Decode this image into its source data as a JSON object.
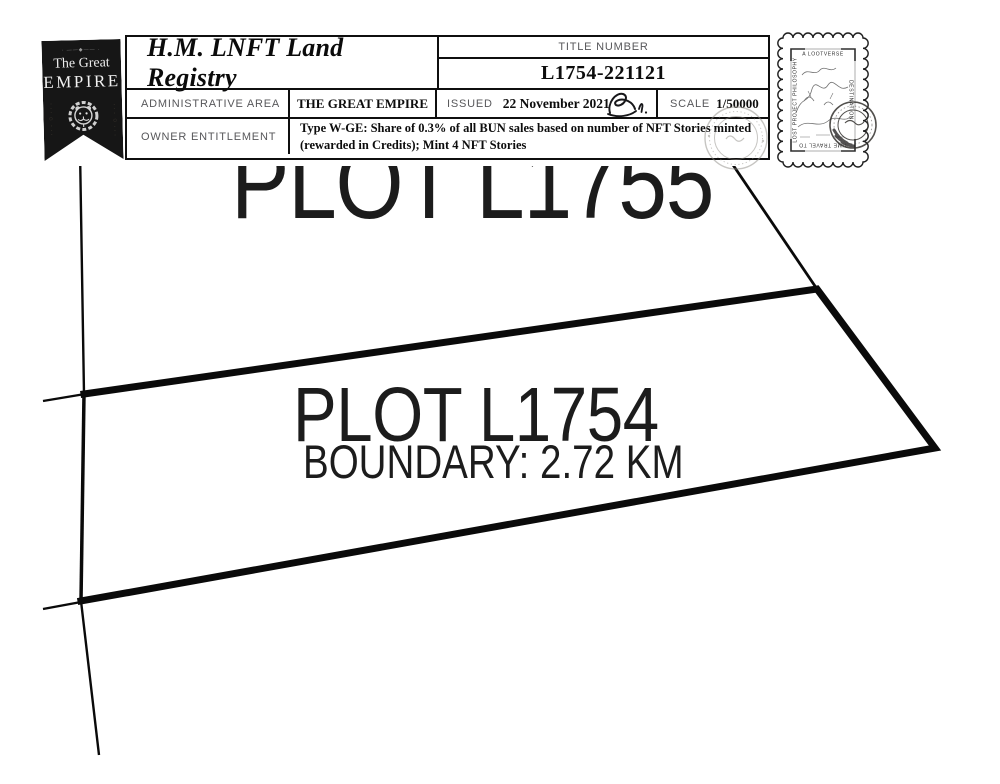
{
  "header": {
    "badge": {
      "ornament": "· ——◆—— ·",
      "line1": "The Great",
      "line2": "EMPIRE",
      "emblem_icon": "lion-crest-icon"
    },
    "registry_title": "H.M. LNFT Land Registry",
    "title_number_label": "TITLE NUMBER",
    "title_number": "L1754-221121",
    "admin_area_label": "ADMINISTRATIVE AREA",
    "admin_area_value": "THE GREAT EMPIRE",
    "issued_label": "ISSUED",
    "issued_date": "22 November 2021",
    "scale_label": "SCALE",
    "scale_value": "1/50000",
    "owner_label": "OWNER ENTITLEMENT",
    "owner_entitlement": "Type W-GE: Share of 0.3% of all BUN sales based on number of NFT Stories minted\n(rewarded in Credits); Mint 4 NFT Stories"
  },
  "stamp": {
    "top_text": "A LOOTVERSE",
    "right_text": "DESTINATION",
    "left_text": "LOST PROJECT PHILOSOPHY",
    "bottom_text": "TIME TRAVEL TO"
  },
  "map": {
    "adjacent_plot_label": "PLOT L1755",
    "plot_label": "PLOT L1754",
    "boundary_label": "BOUNDARY: 2.72 KM"
  },
  "colors": {
    "ink": "#0f0f0f",
    "label_gray": "#57575a",
    "ribbon_black": "#161616",
    "seal_gray": "#8f8c86"
  }
}
